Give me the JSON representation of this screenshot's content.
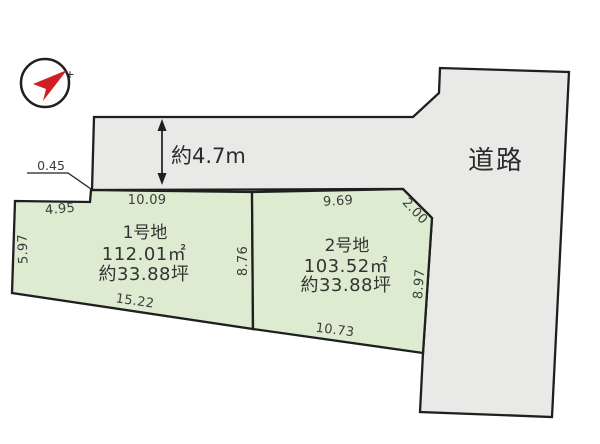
{
  "colors": {
    "road_fill": "#e9e9e7",
    "plot_fill": "#ddecd1",
    "line": "#1f1f1f",
    "dim_text": "#3c3c3c",
    "compass_red": "#d01f24"
  },
  "compass": {
    "tip_mark": "+"
  },
  "road": {
    "label": "道路",
    "width_label": "約4.7m"
  },
  "plot1": {
    "name": "1号地",
    "area_m2": "112.01㎡",
    "area_tsubo": "約33.88坪",
    "dims": {
      "step": "0.45",
      "top_left": "4.95",
      "top": "10.09",
      "left": "5.97",
      "right": "8.76",
      "bottom": "15.22"
    }
  },
  "plot2": {
    "name": "2号地",
    "area_m2": "103.52㎡",
    "area_tsubo": "約33.88坪",
    "dims": {
      "top": "9.69",
      "corner": "2.00",
      "right": "8.97",
      "bottom": "10.73"
    }
  }
}
